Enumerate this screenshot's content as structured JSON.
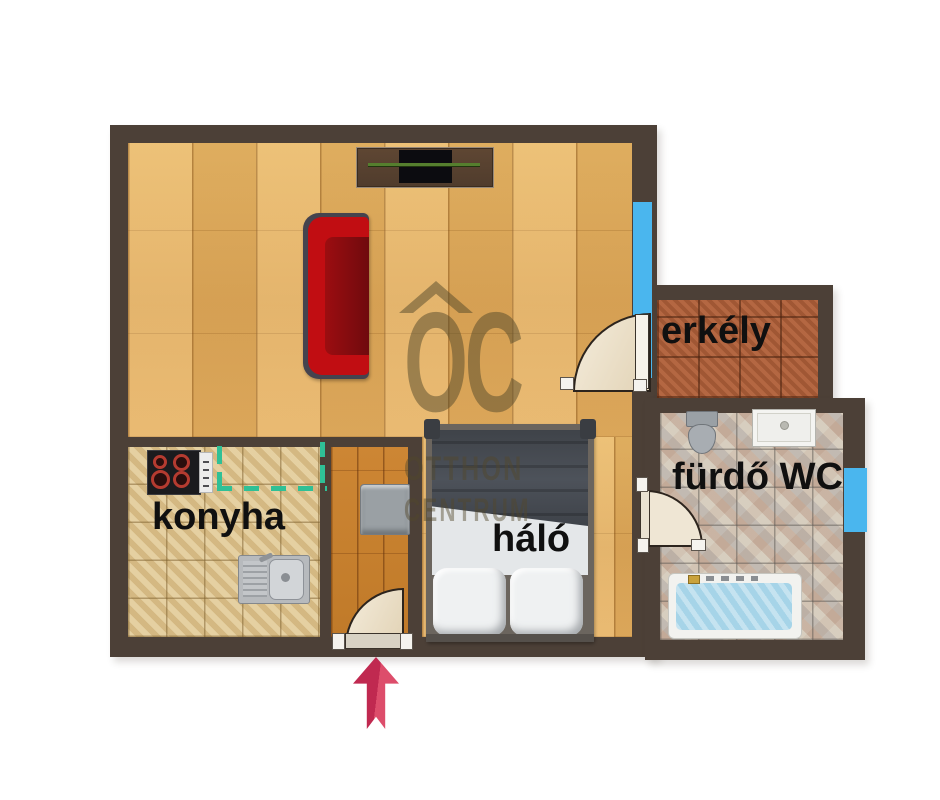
{
  "plan_title": "apartment-floor-plan",
  "rooms": {
    "kitchen": {
      "label": "konyha"
    },
    "bedroom": {
      "label": "háló"
    },
    "bathroom": {
      "label": "fürdő WC"
    },
    "balcony": {
      "label": "erkély"
    }
  },
  "watermark": {
    "logo": "OC",
    "line1": "OTTHON",
    "line2": "CENTRUM"
  },
  "colors": {
    "wall": "#4C4037",
    "window": "#4AB6EE",
    "dashed_opening": "#2FC096",
    "entrance_arrow": "#D13A5C",
    "living_floor": "#E5AF60",
    "hall_floor": "#C8812F",
    "kitchen_floor": "#DCC28D",
    "balcony_floor": "#AE5E38",
    "bathroom_floor": "#CFC6BA",
    "label_text": "#111111"
  },
  "icons": {
    "entrance_arrow": "up-arrow",
    "logo_roof": "roof-chevron"
  }
}
